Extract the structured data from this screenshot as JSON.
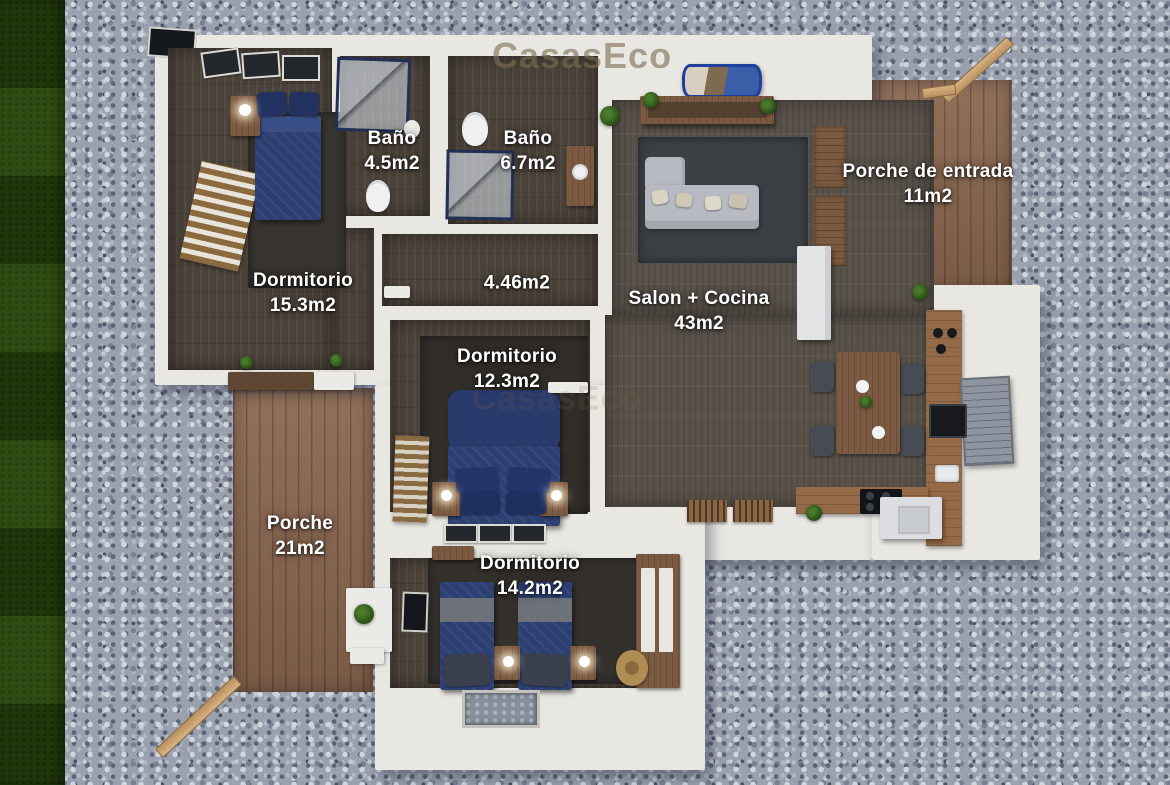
{
  "watermark": {
    "top": "CasasEco",
    "middle": "CasasEco"
  },
  "rooms": {
    "bano1": {
      "name": "Baño",
      "area": "4.5m2"
    },
    "bano2": {
      "name": "Baño",
      "area": "6.7m2"
    },
    "porche_entrada": {
      "name": "Porche de entrada",
      "area": "11m2"
    },
    "dormitorio1": {
      "name": "Dormitorio",
      "area": "15.3m2"
    },
    "pasillo": {
      "area": "4.46m2"
    },
    "salon": {
      "name": "Salon + Cocina",
      "area": "43m2"
    },
    "dormitorio2": {
      "name": "Dormitorio",
      "area": "12.3m2"
    },
    "porche": {
      "name": "Porche",
      "area": "21m2"
    },
    "dormitorio3": {
      "name": "Dormitorio",
      "area": "14.2m2"
    }
  },
  "colors": {
    "gravel": "#9aa1ae",
    "grass": "#27430f",
    "deck_wood": "#8b6750",
    "wall": "#e9e7e2",
    "floor_wood": "#4b4239",
    "salon_floor": "#5a534b",
    "bed_navy": "#2d4074",
    "label_text": "#ffffff",
    "watermark_tint": "#8a7a58"
  }
}
